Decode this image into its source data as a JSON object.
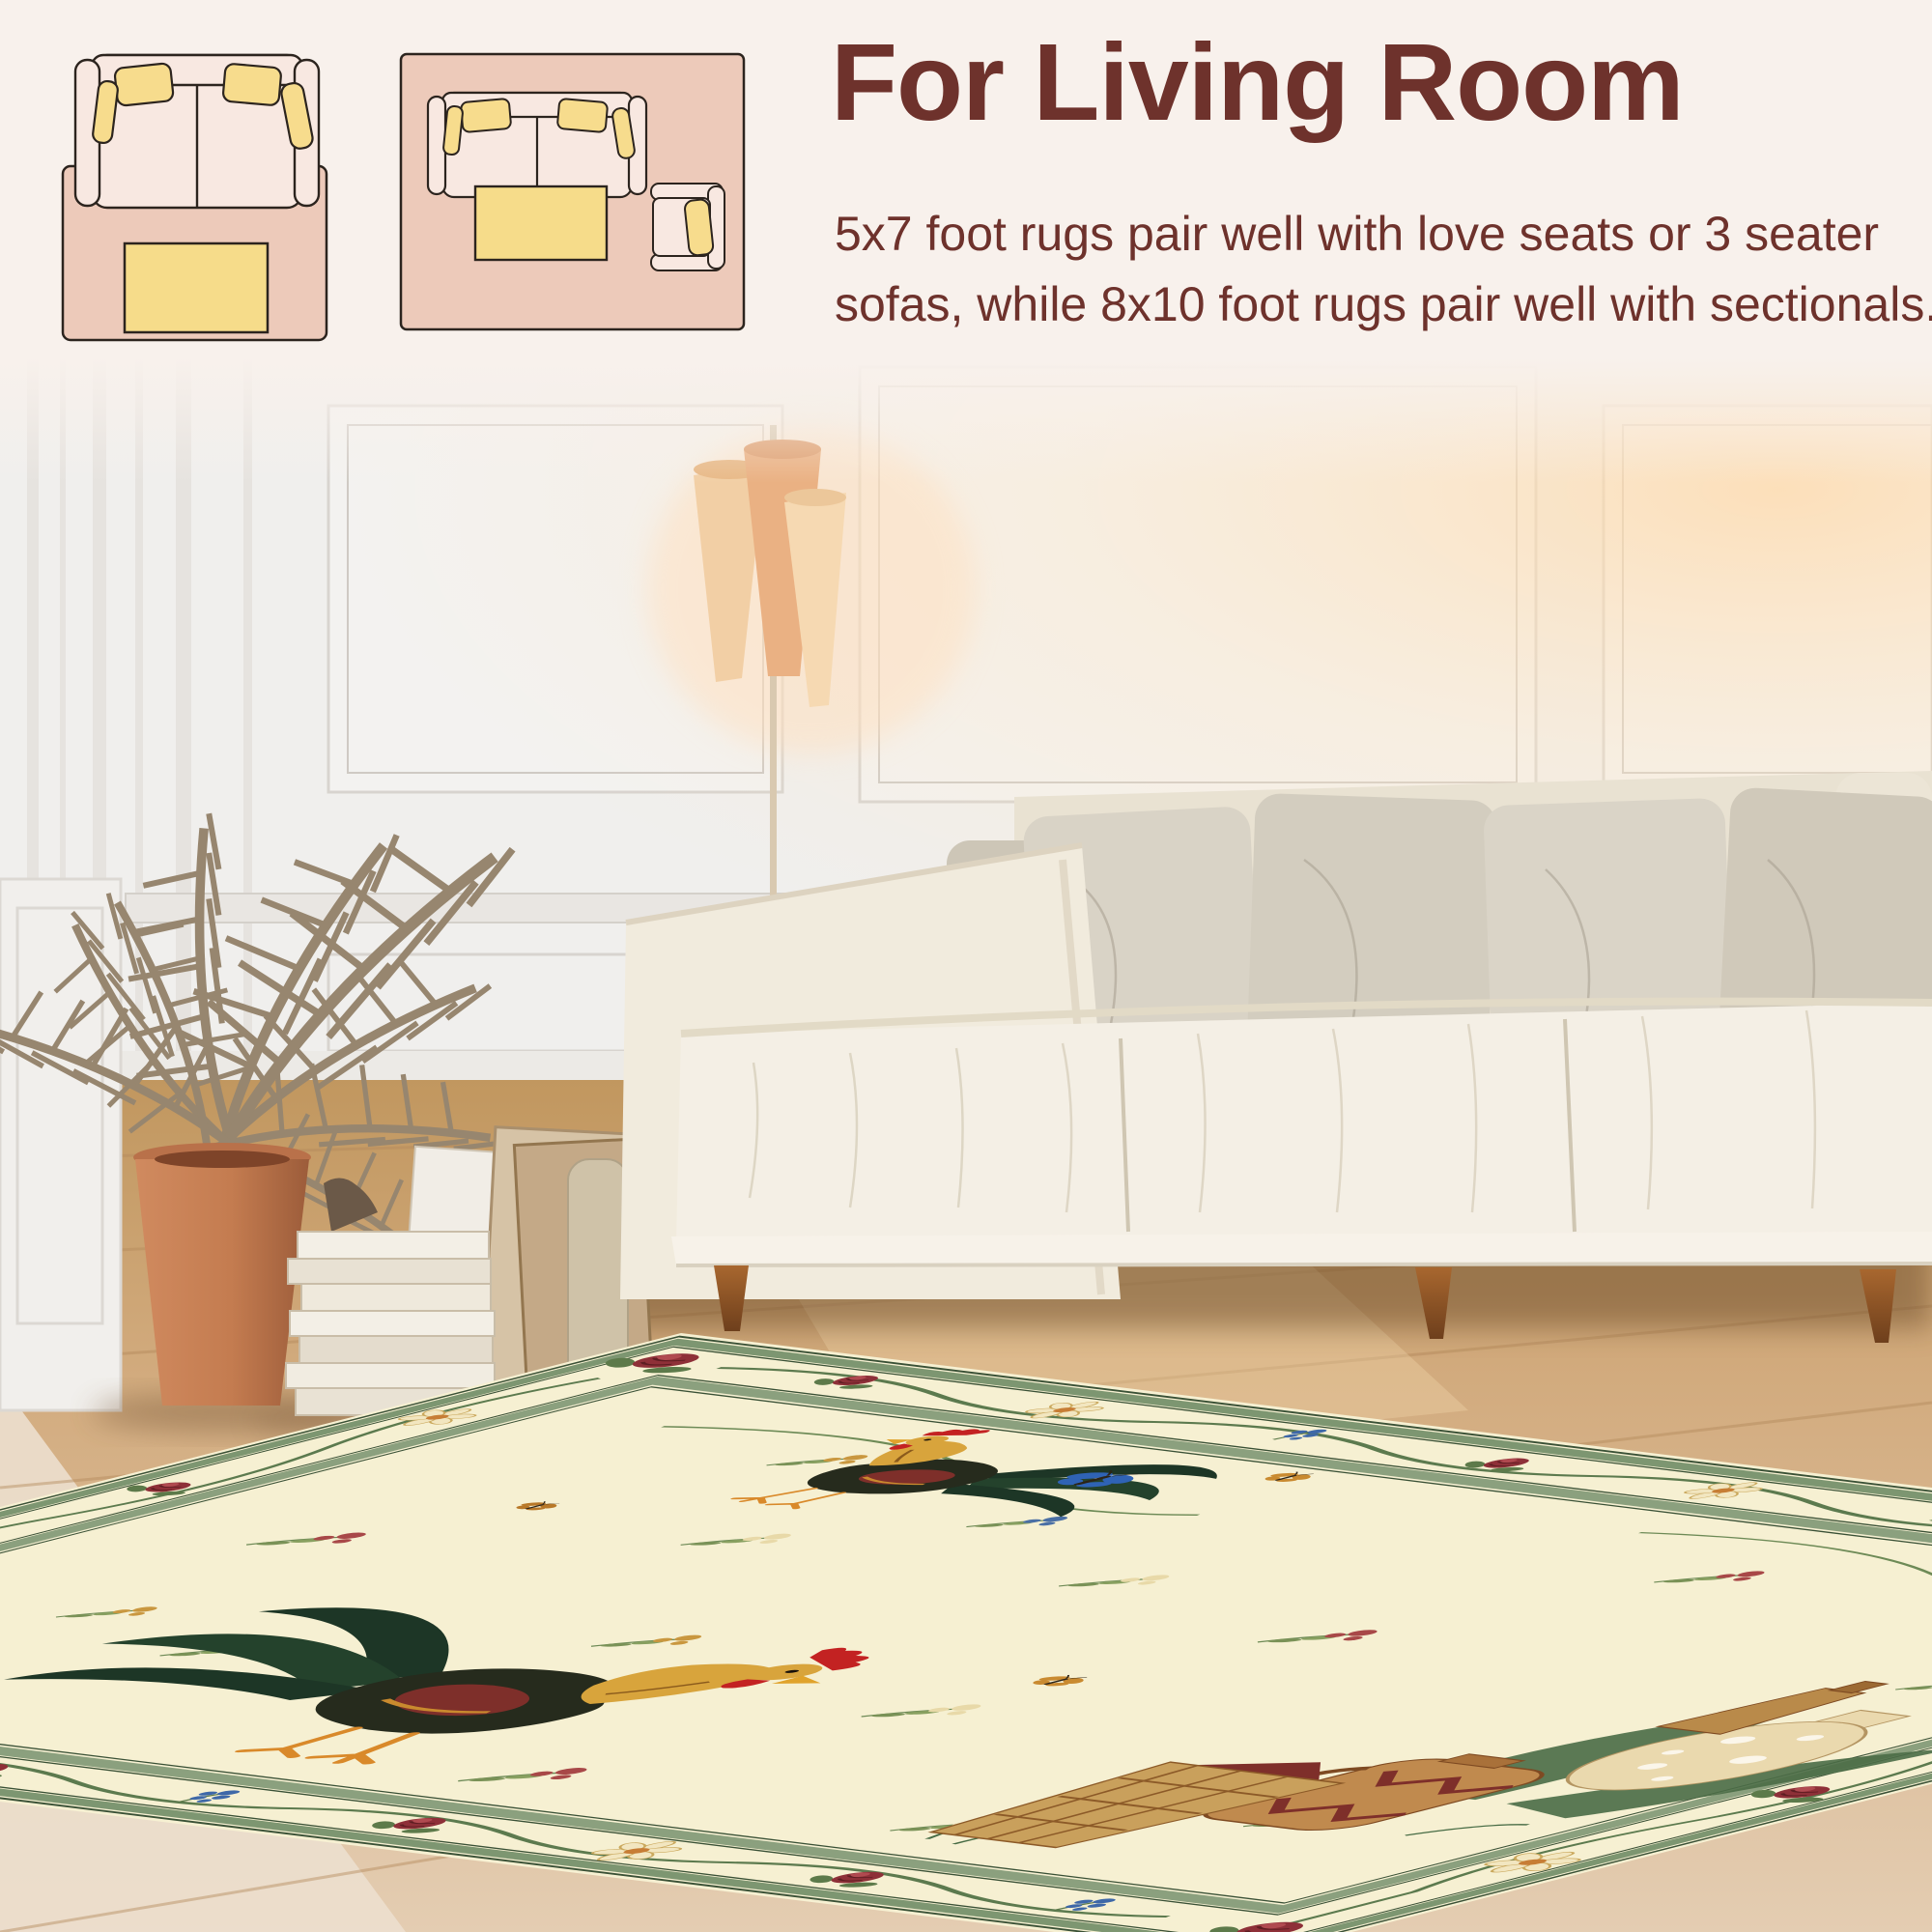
{
  "header": {
    "title": "For Living Room",
    "description_lines": [
      "5x7 foot rugs pair well with love seats or 3 seater",
      "sofas, while 8x10 foot rugs pair well with sectionals."
    ]
  },
  "size_guide": {
    "options": [
      {
        "label": "5x7",
        "icon": "loveseat-on-rug-top-view-icon"
      },
      {
        "label": "8x10",
        "icon": "sofa-armchair-on-rug-top-view-icon"
      }
    ]
  },
  "palette": {
    "page_background": "#f8f1ec",
    "heading_text": "#6e322c",
    "size_label_text": "#7c4b2e",
    "diagram_rug_pink": "#edcaba",
    "diagram_sofa_cream": "#f8e8e1",
    "diagram_pillow_yellow": "#f7dc8d",
    "rug_field_ivory": "#f6f0d2",
    "rug_border_green": "#7d9671",
    "rose_red": "#8e3038",
    "butterfly_blue": "#2f63b5",
    "sofa_cream": "#f3eee4",
    "floor_wood": "#d2ab7e"
  }
}
